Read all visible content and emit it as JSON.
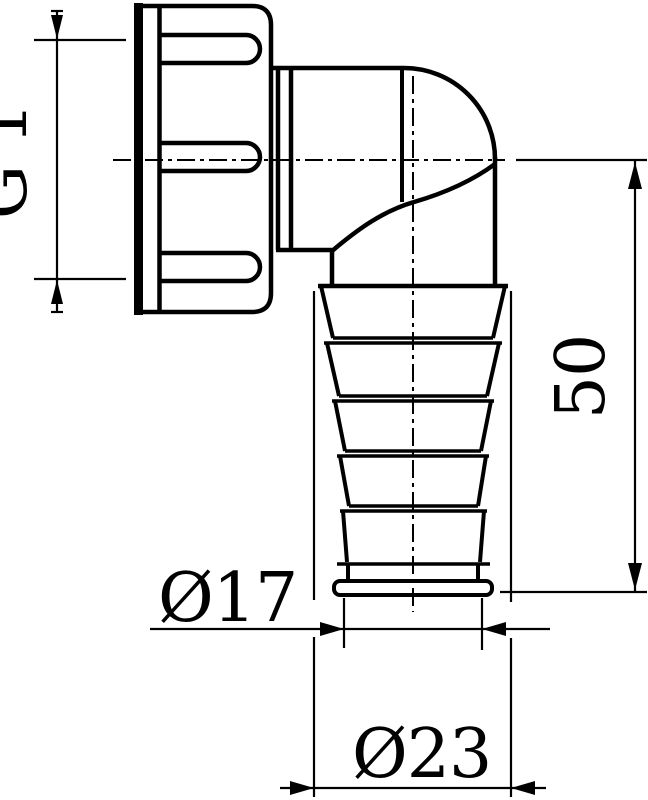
{
  "labels": {
    "thread_size": "G 1\"",
    "height_mm": "50",
    "small_diameter": "Ø17",
    "large_diameter": "Ø23"
  },
  "colors": {
    "line": "#000000",
    "background": "#ffffff"
  }
}
